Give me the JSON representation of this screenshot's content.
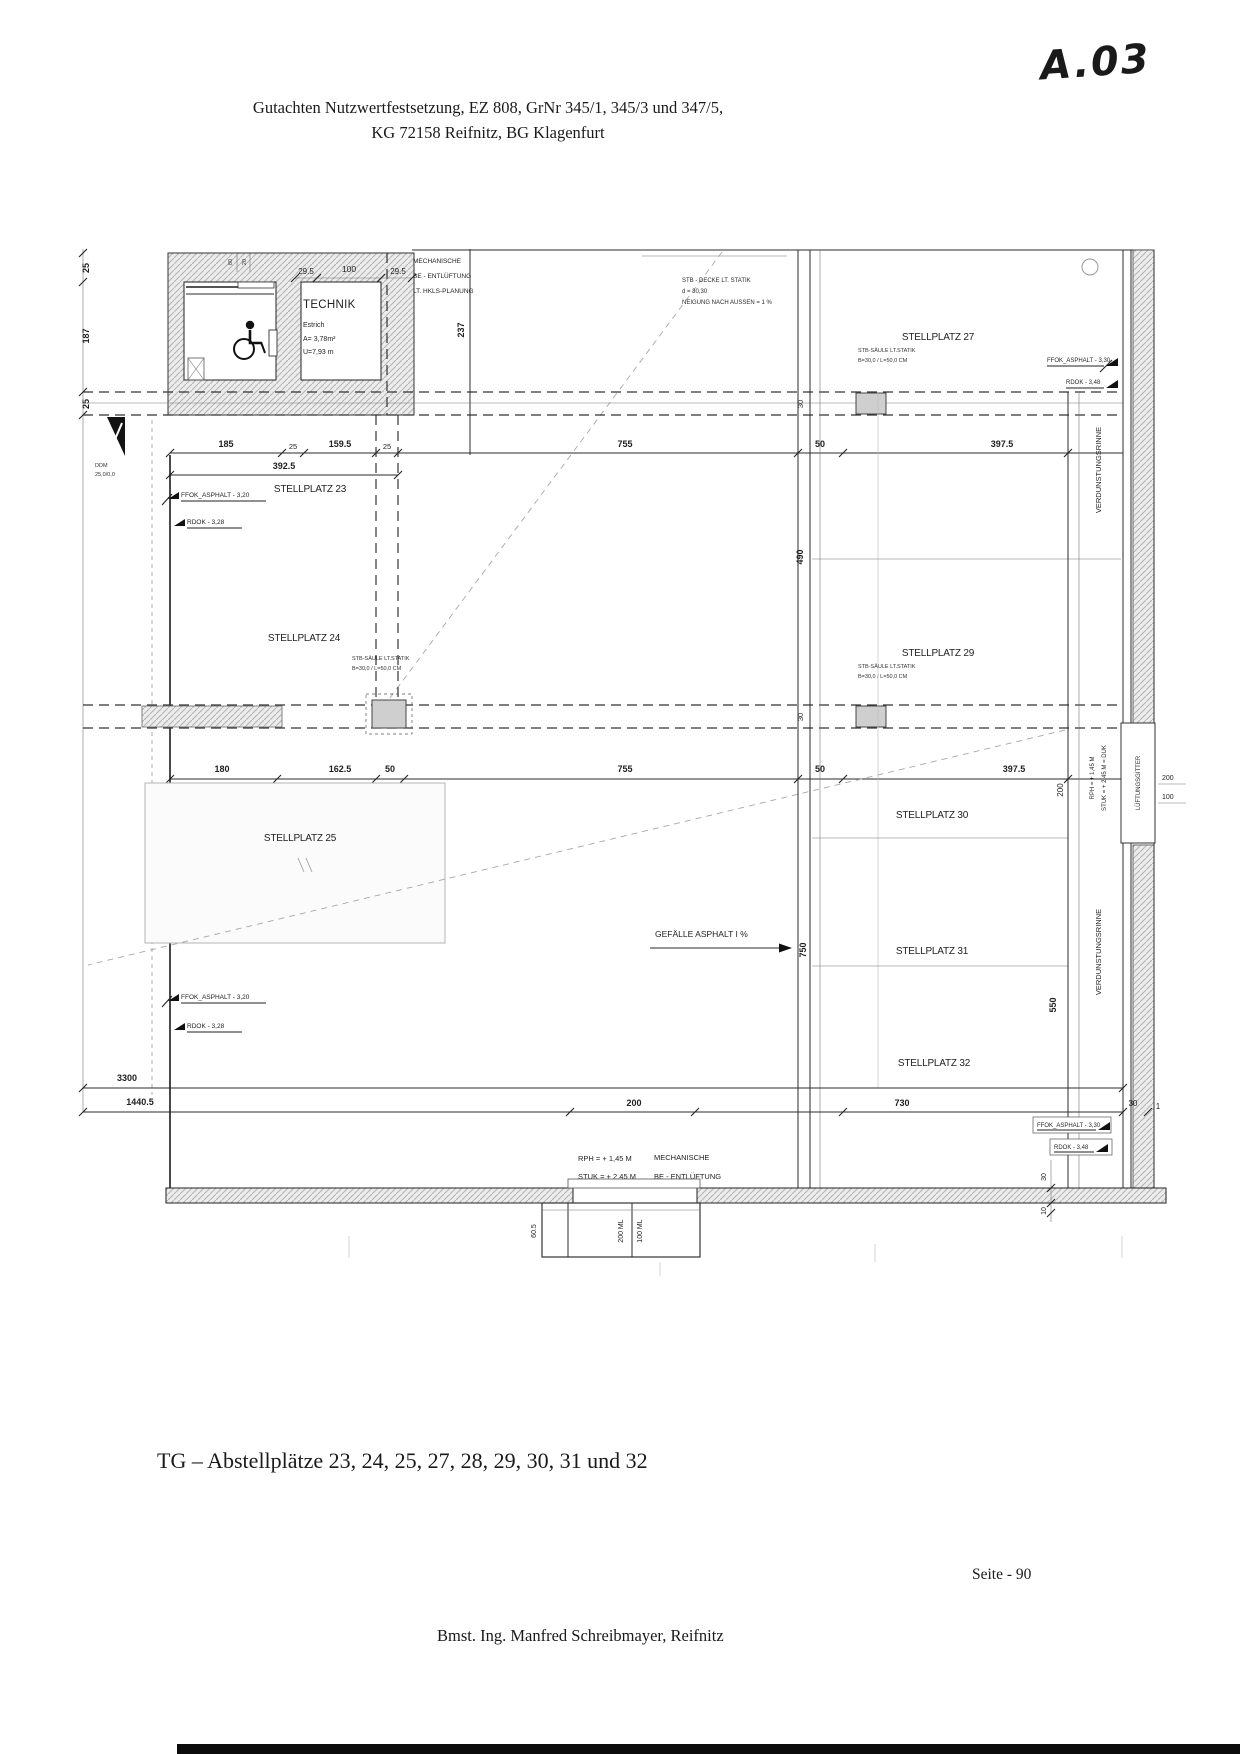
{
  "header": {
    "line1": "Gutachten Nutzwertfestsetzung, EZ 808, GrNr 345/1, 345/3 und 347/5,",
    "line2": "KG 72158 Reifnitz, BG Klagenfurt"
  },
  "annotation": {
    "code": "A.03"
  },
  "caption": "TG – Abstellplätze 23, 24, 25, 27, 28, 29, 30, 31 und 32",
  "footer": {
    "page": "Seite - 90",
    "author": "Bmst. Ing. Manfred Schreibmayer, Reifnitz"
  },
  "plan": {
    "technik": {
      "title": "TECHNIK",
      "l1": "Estrich",
      "l2": "A= 3,78m²",
      "l3": "U=7,93 m"
    },
    "mech_top": {
      "l1": "MECHANISCHE",
      "l2": "BE - ENTLÜFTUNG",
      "l3": "LT. HKLS-PLANUNG"
    },
    "decke": {
      "l1": "STB - DECKE LT. STATIK",
      "l2": "d = 30,30",
      "l3": "NEIGUNG NACH AUSSEN = 1 %"
    },
    "saeule": {
      "l1": "STB-SÄULE  LT.STATIK",
      "l2": "B=30,0 / L=50,0 CM"
    },
    "stalls": {
      "s23": "STELLPLATZ 23",
      "s24": "STELLPLATZ 24",
      "s25": "STELLPLATZ 25",
      "s27": "STELLPLATZ 27",
      "s29": "STELLPLATZ 29",
      "s30": "STELLPLATZ 30",
      "s31": "STELLPLATZ 31",
      "s32": "STELLPLATZ 32"
    },
    "levels": {
      "ffok20": "FFOK_ASPHALT - 3,20",
      "rdok28": "RDOK - 3,28",
      "ffok30": "FFOK_ASPHALT - 3,30",
      "rdok48": "RDOK - 3,48"
    },
    "notes": {
      "verdunstung": "VERDUNSTUNGSRINNE",
      "gitter": "LÜFTUNGSGITTER",
      "gefaelle": "GEFÄLLE ASPHALT I %",
      "rph": "RPH = + 1,45 M",
      "stuk": "STUK = + 2,45 M",
      "stuk_duk": "STUK = + 2,45 M = DUK",
      "mech1": "MECHANISCHE",
      "mech2": "BE - ENTLÜFTUNG",
      "ddm1": "DDM",
      "ddm2": "25,0/0,0"
    },
    "dims": {
      "d185": "185",
      "d25": "25",
      "d1595": "159.5",
      "d3925": "392.5",
      "d755": "755",
      "d50": "50",
      "d3975": "397.5",
      "d180": "180",
      "d1625": "162.5",
      "d3300": "3300",
      "d14405": "1440.5",
      "d200": "200",
      "d730": "730",
      "d30": "30",
      "d1": "1",
      "d10": "10",
      "d187": "187",
      "d237": "237",
      "d490": "490",
      "d750": "750",
      "d550": "550",
      "d100": "100",
      "d295": "29.5",
      "d605": "60.5",
      "d200ml": "200 ML",
      "d100ml": "100 ML",
      "d80": "80",
      "d20": "20"
    }
  }
}
